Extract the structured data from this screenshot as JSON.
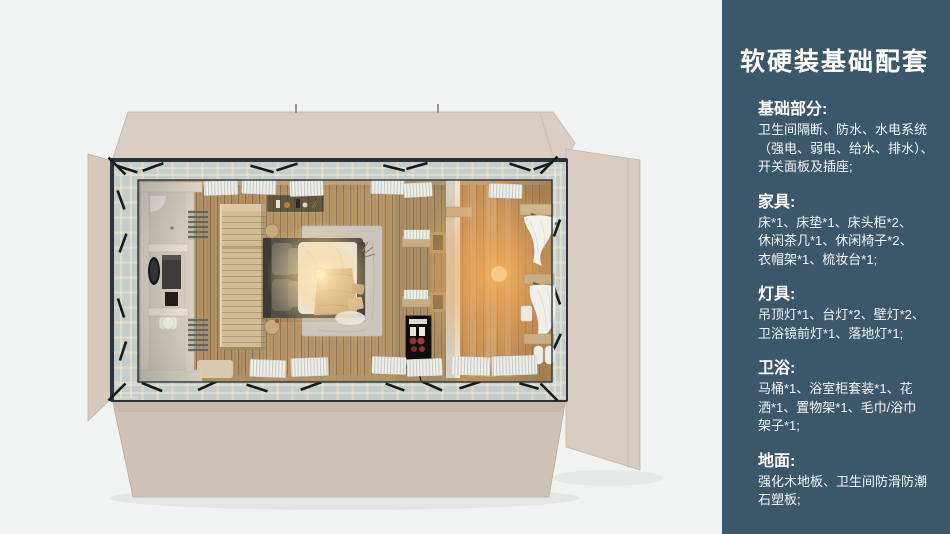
{
  "panel": {
    "title": "软硬装基础配套",
    "sections": [
      {
        "heading": "基础部分:",
        "text": "卫生间隔断、防水、水电系统\n（强电、弱电、给水、排水）、\n开关面板及插座;"
      },
      {
        "heading": "家具:",
        "text": "床*1、床垫*1、床头柜*2、\n休闲茶几*1、休闲椅子*2、\n衣帽架*1、梳妆台*1;"
      },
      {
        "heading": "灯具:",
        "text": "吊顶灯*1、台灯*2、壁灯*2、\n卫浴镜前灯*1、落地灯*1;"
      },
      {
        "heading": "卫浴:",
        "text": "马桶*1、浴室柜套装*1、花\n洒*1、置物架*1、毛巾/浴巾\n架子*1;"
      },
      {
        "heading": "地面:",
        "text": "强化木地板、卫生间防滑防潮\n石塑板;"
      }
    ],
    "colors": {
      "background": "#3c566a",
      "text": "#ffffff"
    }
  },
  "floorplan": {
    "colors": {
      "photo_background": "#f1f2f2",
      "shell_beige": "#d6ccc1",
      "steel_frame": "#2a333d",
      "wood_floor": "#b29165",
      "lamp_glow": "#f8b45e",
      "bathroom_wall": "#ddd5c8"
    }
  }
}
